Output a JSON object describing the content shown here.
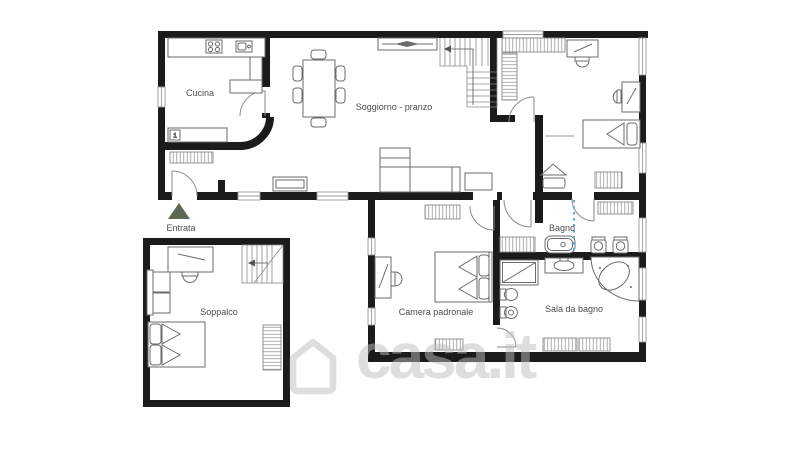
{
  "floor_plan": {
    "room_labels": {
      "cucina": "Cucina",
      "soggiorno_pranzo": "Soggiorno - pranzo",
      "entrata": "Entrata",
      "soppalco": "Soppalco",
      "camera_padronale": "Camera padronale",
      "bagno": "Bagno",
      "sala_da_bagno": "Sala da bagno"
    },
    "fixture_labels": {
      "kitchen_unit_number": "1"
    },
    "colors": {
      "walls": "#1b1b1b",
      "furniture_outline": "#6b6b6b",
      "room_label_text": "#4d4d4d",
      "entrance_marker": "#5c6852",
      "plumbing_line": "#58aed3",
      "watermark": "#bebebe",
      "background": "#ffffff"
    }
  },
  "watermark": {
    "text": "casa.it",
    "icon": "house-outline-icon"
  }
}
